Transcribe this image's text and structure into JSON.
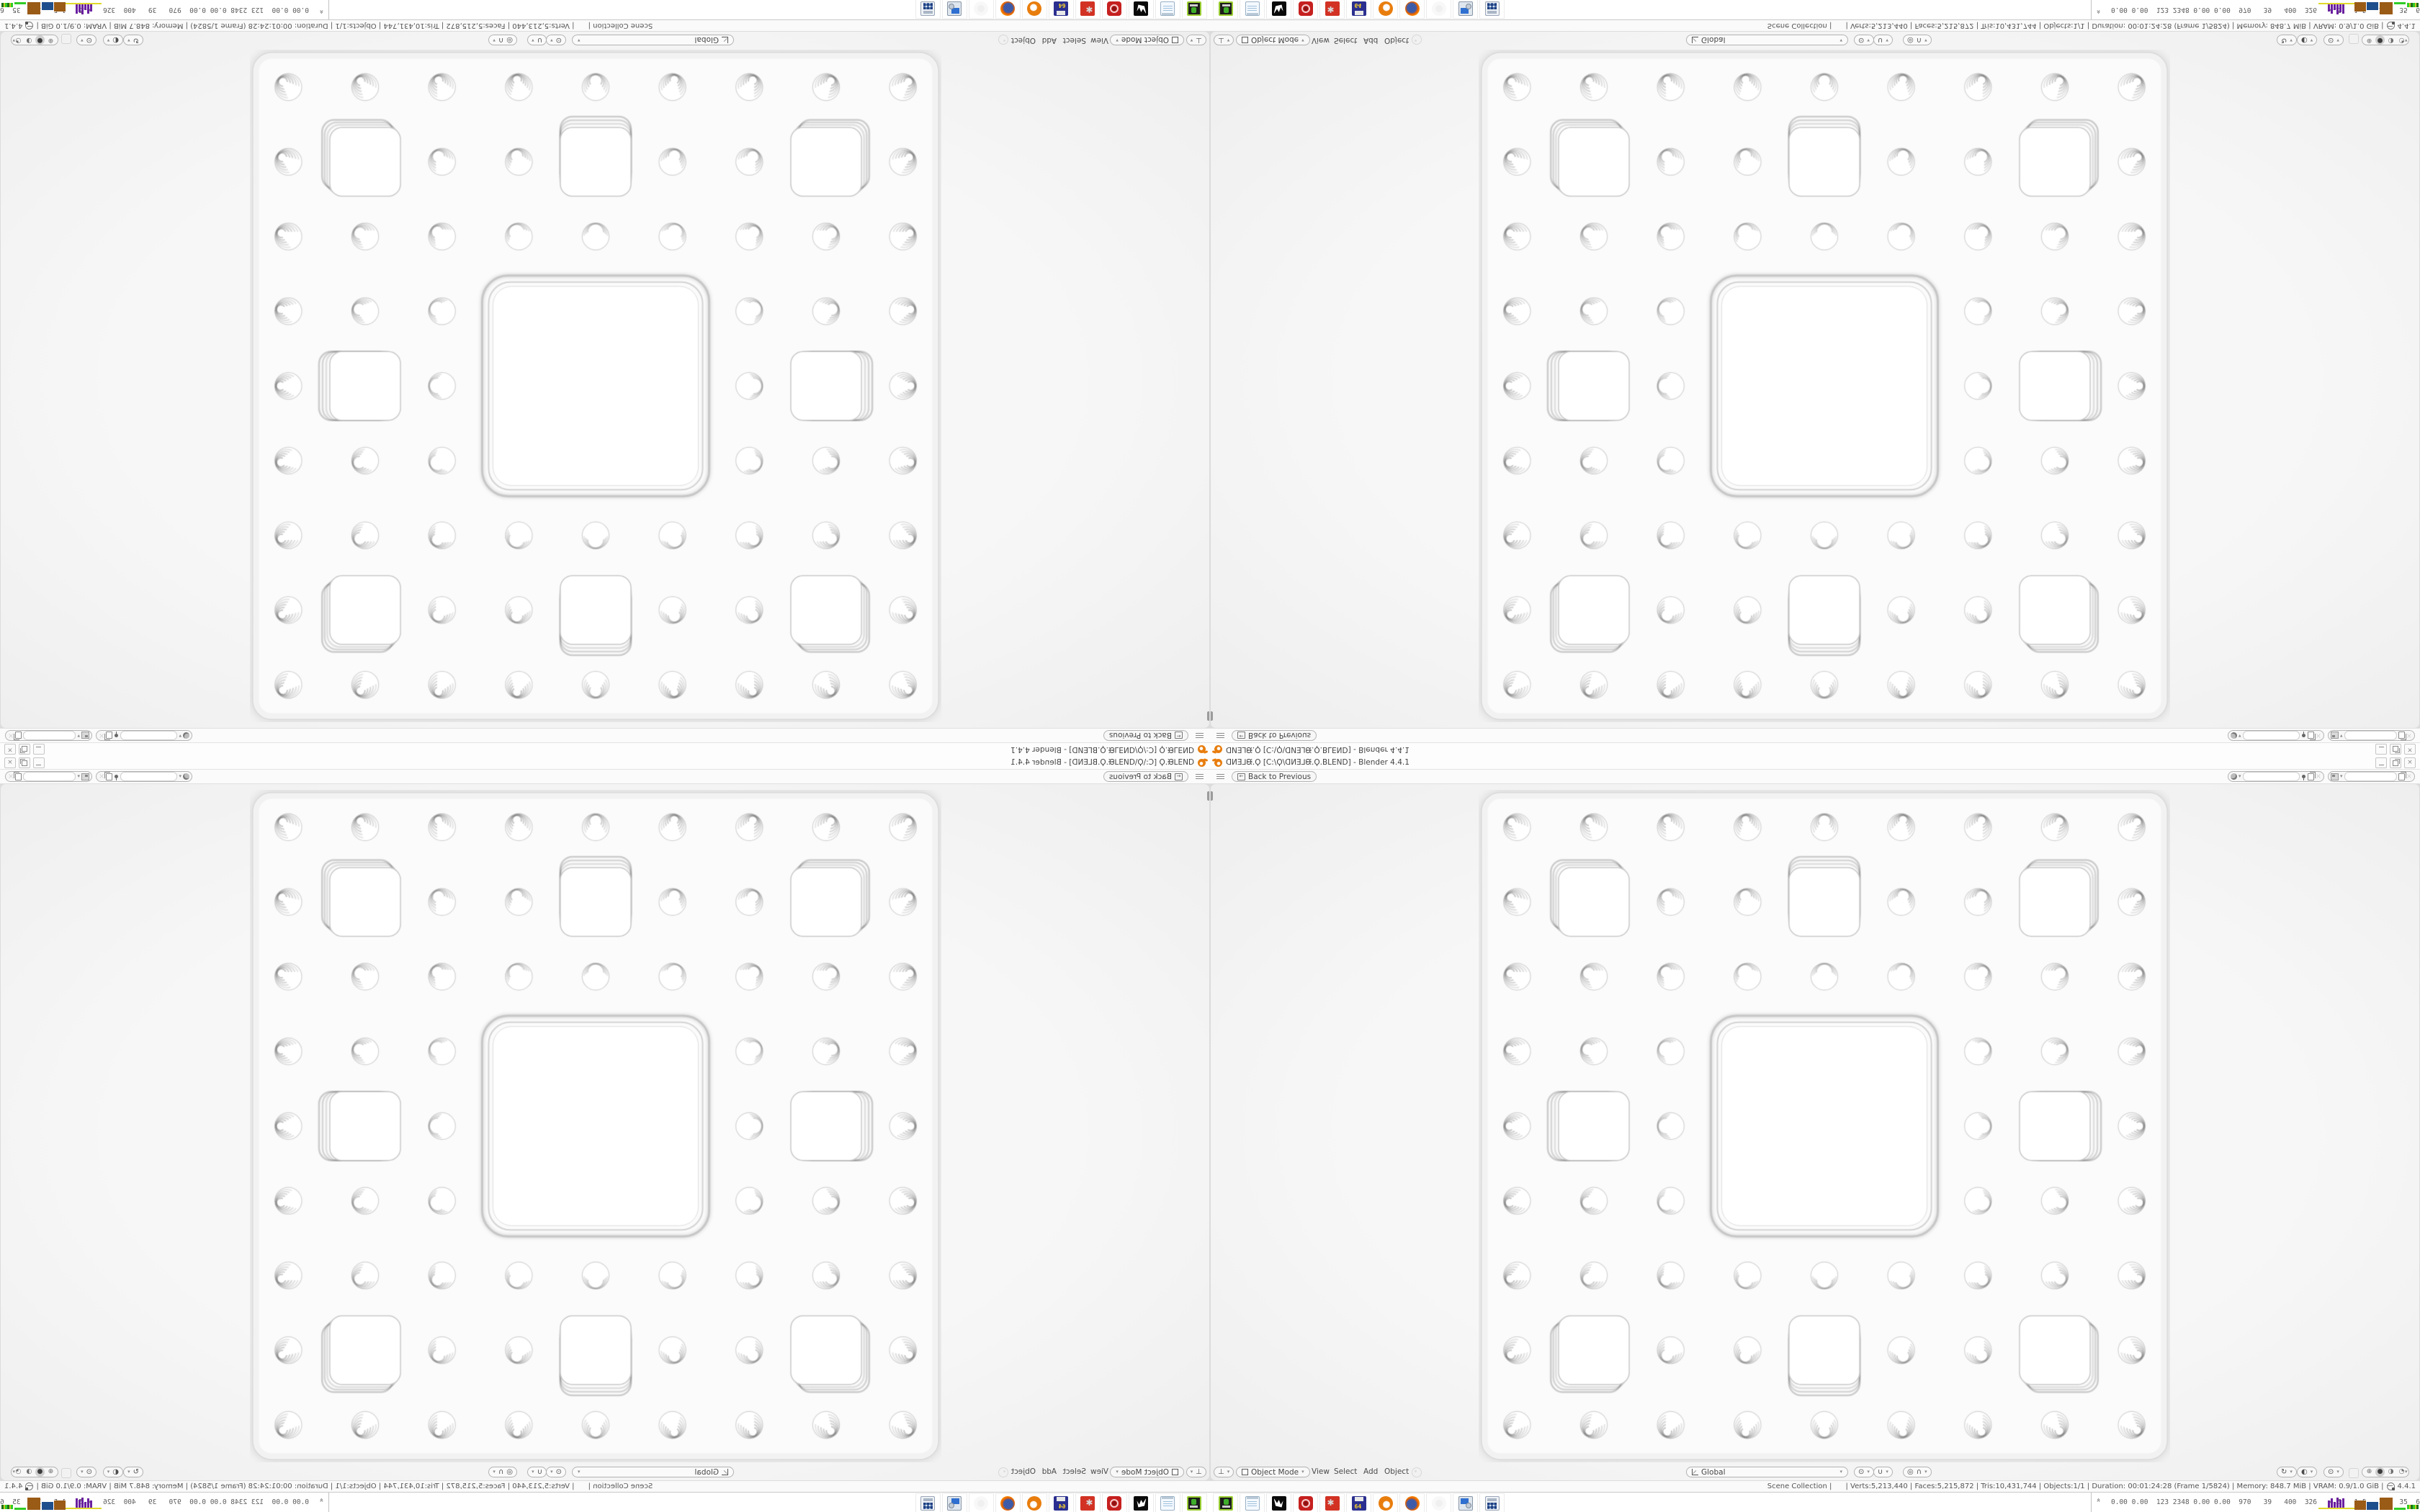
{
  "app": {
    "name": "Blender",
    "version": "4.4.1"
  },
  "window": {
    "title": "ᗡИƎ⅃ᙠ.Ϙ [C:\\Ϙ\\ᗡИƎ⅃ᙠ.Ϙ.BLEND] - Blender 4.4.1",
    "controls": {
      "minimize": "–",
      "maximize": "❐",
      "close": "×"
    }
  },
  "topbar": {
    "back_button": "Back to Previous",
    "scene_field": "",
    "view_layer_field": ""
  },
  "viewport": {
    "mode": "Object Mode",
    "menus": [
      "View",
      "Select",
      "Add",
      "Object"
    ],
    "orientation": "Global",
    "shading_modes": [
      "wireframe",
      "solid",
      "material",
      "rendered"
    ],
    "shading_active": "solid",
    "sponge": {
      "type": "menger-sponge-front-view",
      "grid": 9,
      "colors": {
        "slab": "#fbfbfb",
        "hole": "#ffffff",
        "line": "#c6c6c6",
        "soft": "#d9d9d9",
        "viewport_bg": "#f3f3f3"
      }
    }
  },
  "status_bar": {
    "text": "Scene Collection |      | Verts:5,213,440 | Faces:5,215,872 | Tris:10,431,744 | Objects:1/1 | Duration: 00:01:24:28 (Frame 1/5824) | Memory: 848.7 MiB | VRAM: 0.9/1.0 GiB |",
    "version": "4.4.1"
  },
  "taskbar": {
    "apps": [
      "emulator",
      "notepad",
      "ink-app",
      "red-badge-app",
      "red-gear-app",
      "floppy-64",
      "blender",
      "firefox",
      "ghost-app",
      "display-settings",
      "calculator"
    ],
    "monitor_values": "0.00 0.00  123 2348 0.00 0.00  970   39   400  326   4.5   1.5   39   35  6427|2965",
    "graph_colors": {
      "yellow": "#e0d92a",
      "purple": "#6a1fa0",
      "brown": "#9a5b16",
      "blue": "#1f4e8c",
      "green": "#2fcc25"
    },
    "purple_bar_heights": [
      10,
      13,
      8,
      14,
      11,
      13
    ]
  },
  "icons": {
    "chevron": "▾",
    "back_arrow": "←",
    "editor_type": "⊥",
    "pivot": "⊙",
    "magnet": "∪",
    "prop_toggle": "◎",
    "falloff": "∩",
    "gizmo": "↻",
    "overlay": "◐",
    "shade_wire": "⊕",
    "shade_solid": "●",
    "shade_material": "◑",
    "shade_render": "◔"
  }
}
